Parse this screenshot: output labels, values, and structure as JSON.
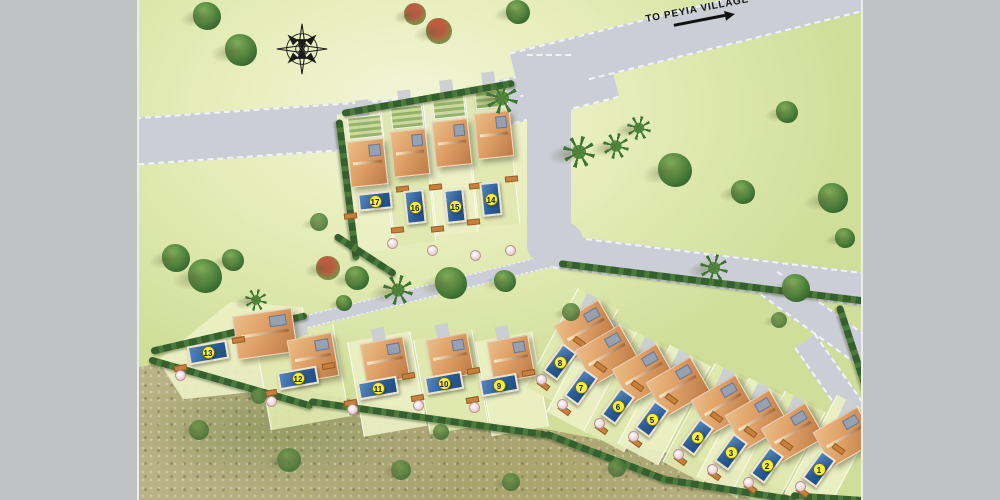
{
  "scene": {
    "type": "residential development site plan",
    "colors": {
      "frame": "#c1c2c4",
      "road": "#cbced6",
      "roadEdge": "#f2f3f7",
      "grassLight": "#f3f6d8",
      "grassMid": "#e6edba",
      "grassDark": "#d0de99",
      "hedge": "#33602c",
      "hedge2": "#4a7a3c",
      "poolBorder": "#ece4cd",
      "roofLight": "#eabd87",
      "roofDark": "#bd7b46",
      "badgeBg": "#f6ef3f",
      "badgeBorder": "#70702a",
      "badgeText": "#1c1c1c",
      "treeLight": "#83b05a",
      "treeMid": "#4a7d3a",
      "treeDark": "#2f5c28"
    }
  },
  "sign": {
    "text": "TO PEYIA VILLAGE"
  },
  "compass": {
    "name": "compass-rose"
  },
  "roads": [
    {
      "x": -12,
      "y": 118,
      "w": 352,
      "h": 48,
      "rot": -4
    },
    {
      "x": 300,
      "y": 96,
      "w": 180,
      "h": 46,
      "rot": -14
    },
    {
      "x": 376,
      "y": 52,
      "w": 390,
      "h": 46,
      "rot": -14
    },
    {
      "x": 388,
      "y": 54,
      "w": 44,
      "h": 194,
      "rot": 0
    },
    {
      "x": 396,
      "y": 232,
      "w": 342,
      "h": 34,
      "rot": 7
    },
    {
      "x": 630,
      "y": 268,
      "w": 140,
      "h": 30,
      "rot": 36
    },
    {
      "x": 666,
      "y": 328,
      "w": 122,
      "h": 26,
      "rot": 55
    },
    {
      "x": 148,
      "y": 320,
      "w": 272,
      "h": 13,
      "rot": -14,
      "thin": true
    }
  ],
  "road_blobs": [
    {
      "x": 382,
      "y": 58,
      "w": 66,
      "h": 52
    },
    {
      "x": 388,
      "y": 220,
      "w": 56,
      "h": 46
    }
  ],
  "sand": {
    "top": 340,
    "height": 160,
    "points": [
      [
        0,
        27
      ],
      [
        55,
        18
      ],
      [
        115,
        28
      ],
      [
        178,
        53
      ],
      [
        300,
        75
      ],
      [
        412,
        90
      ],
      [
        524,
        112
      ],
      [
        602,
        132
      ],
      [
        650,
        152
      ],
      [
        658,
        160
      ],
      [
        0,
        160
      ]
    ]
  },
  "hedges": [
    [
      200,
      116,
      142,
      83
    ],
    [
      203,
      110,
      175,
      -10
    ],
    [
      12,
      348,
      160,
      -13
    ],
    [
      10,
      356,
      170,
      16
    ],
    [
      170,
      398,
      240,
      8
    ],
    [
      406,
      430,
      132,
      21
    ],
    [
      526,
      476,
      132,
      9
    ],
    [
      420,
      260,
      312,
      7
    ],
    [
      700,
      302,
      130,
      72
    ],
    [
      652,
      492,
      80,
      4
    ],
    [
      196,
      232,
      72,
      33
    ]
  ],
  "trees": [
    [
      "tree",
      68,
      16,
      14
    ],
    [
      "tree",
      102,
      50,
      16
    ],
    [
      "shrub",
      276,
      14,
      11
    ],
    [
      "shrub",
      300,
      31,
      13
    ],
    [
      "tree",
      379,
      12,
      12
    ],
    [
      "palm",
      363,
      98,
      16
    ],
    [
      "palm",
      500,
      128,
      12
    ],
    [
      "tree",
      648,
      112,
      11
    ],
    [
      "palm",
      440,
      152,
      16
    ],
    [
      "palm",
      477,
      146,
      13
    ],
    [
      "tree",
      536,
      170,
      17
    ],
    [
      "tree",
      604,
      192,
      12
    ],
    [
      "tree",
      694,
      198,
      15
    ],
    [
      "tree",
      37,
      258,
      14
    ],
    [
      "tree",
      66,
      276,
      17
    ],
    [
      "tree",
      94,
      260,
      11
    ],
    [
      "shrub",
      189,
      268,
      12
    ],
    [
      "tree",
      218,
      278,
      12
    ],
    [
      "palm",
      259,
      290,
      15
    ],
    [
      "tree",
      312,
      283,
      16
    ],
    [
      "tree",
      366,
      281,
      11
    ],
    [
      "tree",
      205,
      303,
      8
    ],
    [
      "palm",
      575,
      268,
      14
    ],
    [
      "tree",
      657,
      288,
      14
    ],
    [
      "bush",
      432,
      312,
      9
    ],
    [
      "palm",
      117,
      300,
      11
    ],
    [
      "bush",
      180,
      222,
      9
    ],
    [
      "tree",
      706,
      238,
      10
    ],
    [
      "bush",
      60,
      430,
      10
    ],
    [
      "bush",
      150,
      460,
      12
    ],
    [
      "bush",
      262,
      470,
      10
    ],
    [
      "bush",
      372,
      482,
      9
    ],
    [
      "bush",
      120,
      396,
      8
    ],
    [
      "bush",
      302,
      432,
      8
    ],
    [
      "bush",
      478,
      468,
      9
    ],
    [
      "bush",
      640,
      320,
      8
    ]
  ],
  "villas": [
    {
      "num": "17",
      "strip": [
        205,
        112,
        43,
        140,
        -6
      ],
      "drive": [
        218,
        100,
        13,
        36,
        -6
      ],
      "garden": [
        209,
        116,
        32,
        20,
        -6
      ],
      "house": [
        210,
        140,
        37,
        46,
        -6
      ],
      "pool": [
        219,
        192,
        34,
        18,
        -6
      ],
      "tb": [
        248,
        238
      ]
    },
    {
      "num": "16",
      "strip": [
        248,
        102,
        42,
        142,
        -6
      ],
      "drive": [
        260,
        90,
        13,
        36,
        -6
      ],
      "garden": [
        252,
        106,
        30,
        20,
        -6
      ],
      "house": [
        253,
        130,
        36,
        46,
        -6
      ],
      "pool": [
        266,
        190,
        20,
        34,
        -6
      ],
      "tb": [
        288,
        245
      ]
    },
    {
      "num": "15",
      "strip": [
        290,
        92,
        42,
        142,
        -6
      ],
      "drive": [
        302,
        80,
        13,
        36,
        -6
      ],
      "garden": [
        294,
        96,
        30,
        20,
        -6
      ],
      "house": [
        295,
        120,
        36,
        46,
        -6
      ],
      "pool": [
        306,
        189,
        20,
        34,
        -6
      ],
      "tb": [
        331,
        250
      ]
    },
    {
      "num": "14",
      "strip": [
        332,
        84,
        42,
        142,
        -6
      ],
      "drive": [
        344,
        72,
        13,
        36,
        -6
      ],
      "garden": [
        336,
        88,
        28,
        18,
        -6
      ],
      "house": [
        337,
        112,
        36,
        46,
        -6
      ],
      "pool": [
        342,
        182,
        20,
        34,
        -6
      ],
      "tb": [
        366,
        245
      ]
    },
    {
      "num": "13",
      "tri": true,
      "strip": [
        18,
        302,
        150,
        92,
        -6
      ],
      "drive": [
        126,
        314,
        12,
        22,
        -20
      ],
      "house": [
        96,
        312,
        60,
        44,
        -8
      ],
      "pool": [
        49,
        343,
        40,
        19,
        -10
      ],
      "tb": [
        36,
        370
      ]
    },
    {
      "num": "12",
      "strip": [
        123,
        330,
        80,
        94,
        -10
      ],
      "drive": [
        155,
        320,
        13,
        16,
        -10
      ],
      "house": [
        151,
        336,
        46,
        44,
        -10
      ],
      "pool": [
        139,
        369,
        40,
        18,
        -10
      ],
      "tb": [
        127,
        396
      ]
    },
    {
      "num": "11",
      "strip": [
        216,
        336,
        64,
        96,
        -10
      ],
      "drive": [
        233,
        328,
        13,
        14,
        -10
      ],
      "house": [
        224,
        340,
        44,
        42,
        -10
      ],
      "pool": [
        219,
        379,
        40,
        18,
        -10
      ],
      "tb": [
        208,
        404
      ]
    },
    {
      "num": "10",
      "strip": [
        282,
        334,
        60,
        96,
        -10
      ],
      "drive": [
        297,
        324,
        13,
        16,
        -10
      ],
      "house": [
        290,
        336,
        42,
        42,
        -10
      ],
      "pool": [
        286,
        374,
        38,
        18,
        -10
      ],
      "tb": [
        274,
        400
      ]
    },
    {
      "num": "9",
      "strip": [
        344,
        336,
        58,
        96,
        -10
      ],
      "drive": [
        357,
        326,
        13,
        16,
        -10
      ],
      "house": [
        351,
        338,
        42,
        42,
        -10
      ],
      "pool": [
        341,
        376,
        38,
        18,
        -10
      ],
      "tb": [
        330,
        402
      ]
    },
    {
      "num": "8",
      "strip": [
        410,
        292,
        46,
        112,
        28
      ],
      "drive": [
        441,
        294,
        12,
        30,
        25
      ],
      "house": [
        421,
        310,
        52,
        40,
        -30
      ],
      "pool": [
        412,
        345,
        18,
        34,
        36
      ],
      "tb": [
        397,
        374
      ]
    },
    {
      "num": "7",
      "strip": [
        431,
        317,
        46,
        112,
        28
      ],
      "drive": [
        462,
        319,
        12,
        30,
        25
      ],
      "house": [
        442,
        335,
        52,
        40,
        -30
      ],
      "pool": [
        433,
        370,
        18,
        34,
        36
      ],
      "tb": [
        418,
        399
      ]
    },
    {
      "num": "6",
      "strip": [
        468,
        336,
        46,
        112,
        28
      ],
      "drive": [
        499,
        338,
        12,
        30,
        25
      ],
      "house": [
        479,
        354,
        52,
        40,
        -30
      ],
      "pool": [
        470,
        389,
        18,
        34,
        36
      ],
      "tb": [
        455,
        418
      ]
    },
    {
      "num": "5",
      "strip": [
        502,
        349,
        46,
        112,
        28
      ],
      "drive": [
        533,
        351,
        12,
        30,
        25
      ],
      "house": [
        513,
        367,
        52,
        40,
        -30
      ],
      "pool": [
        504,
        402,
        18,
        34,
        36
      ],
      "tb": [
        489,
        431
      ]
    },
    {
      "num": "4",
      "strip": [
        547,
        367,
        46,
        112,
        28
      ],
      "drive": [
        578,
        369,
        12,
        30,
        25
      ],
      "house": [
        558,
        385,
        52,
        40,
        -30
      ],
      "pool": [
        549,
        420,
        18,
        34,
        36
      ],
      "tb": [
        534,
        449
      ]
    },
    {
      "num": "3",
      "strip": [
        581,
        382,
        46,
        112,
        28
      ],
      "drive": [
        612,
        384,
        12,
        30,
        25
      ],
      "house": [
        592,
        400,
        52,
        40,
        -30
      ],
      "pool": [
        583,
        435,
        18,
        34,
        36
      ],
      "tb": [
        568,
        464
      ]
    },
    {
      "num": "2",
      "strip": [
        617,
        395,
        46,
        112,
        28
      ],
      "drive": [
        648,
        397,
        12,
        30,
        25
      ],
      "house": [
        628,
        413,
        52,
        40,
        -30
      ],
      "pool": [
        619,
        448,
        18,
        34,
        36
      ],
      "tb": [
        604,
        477
      ]
    },
    {
      "num": "1",
      "strip": [
        669,
        399,
        46,
        112,
        28
      ],
      "drive": [
        700,
        401,
        12,
        30,
        25
      ],
      "house": [
        680,
        417,
        52,
        40,
        -30
      ],
      "pool": [
        671,
        452,
        18,
        34,
        36
      ],
      "tb": [
        656,
        481
      ]
    }
  ]
}
